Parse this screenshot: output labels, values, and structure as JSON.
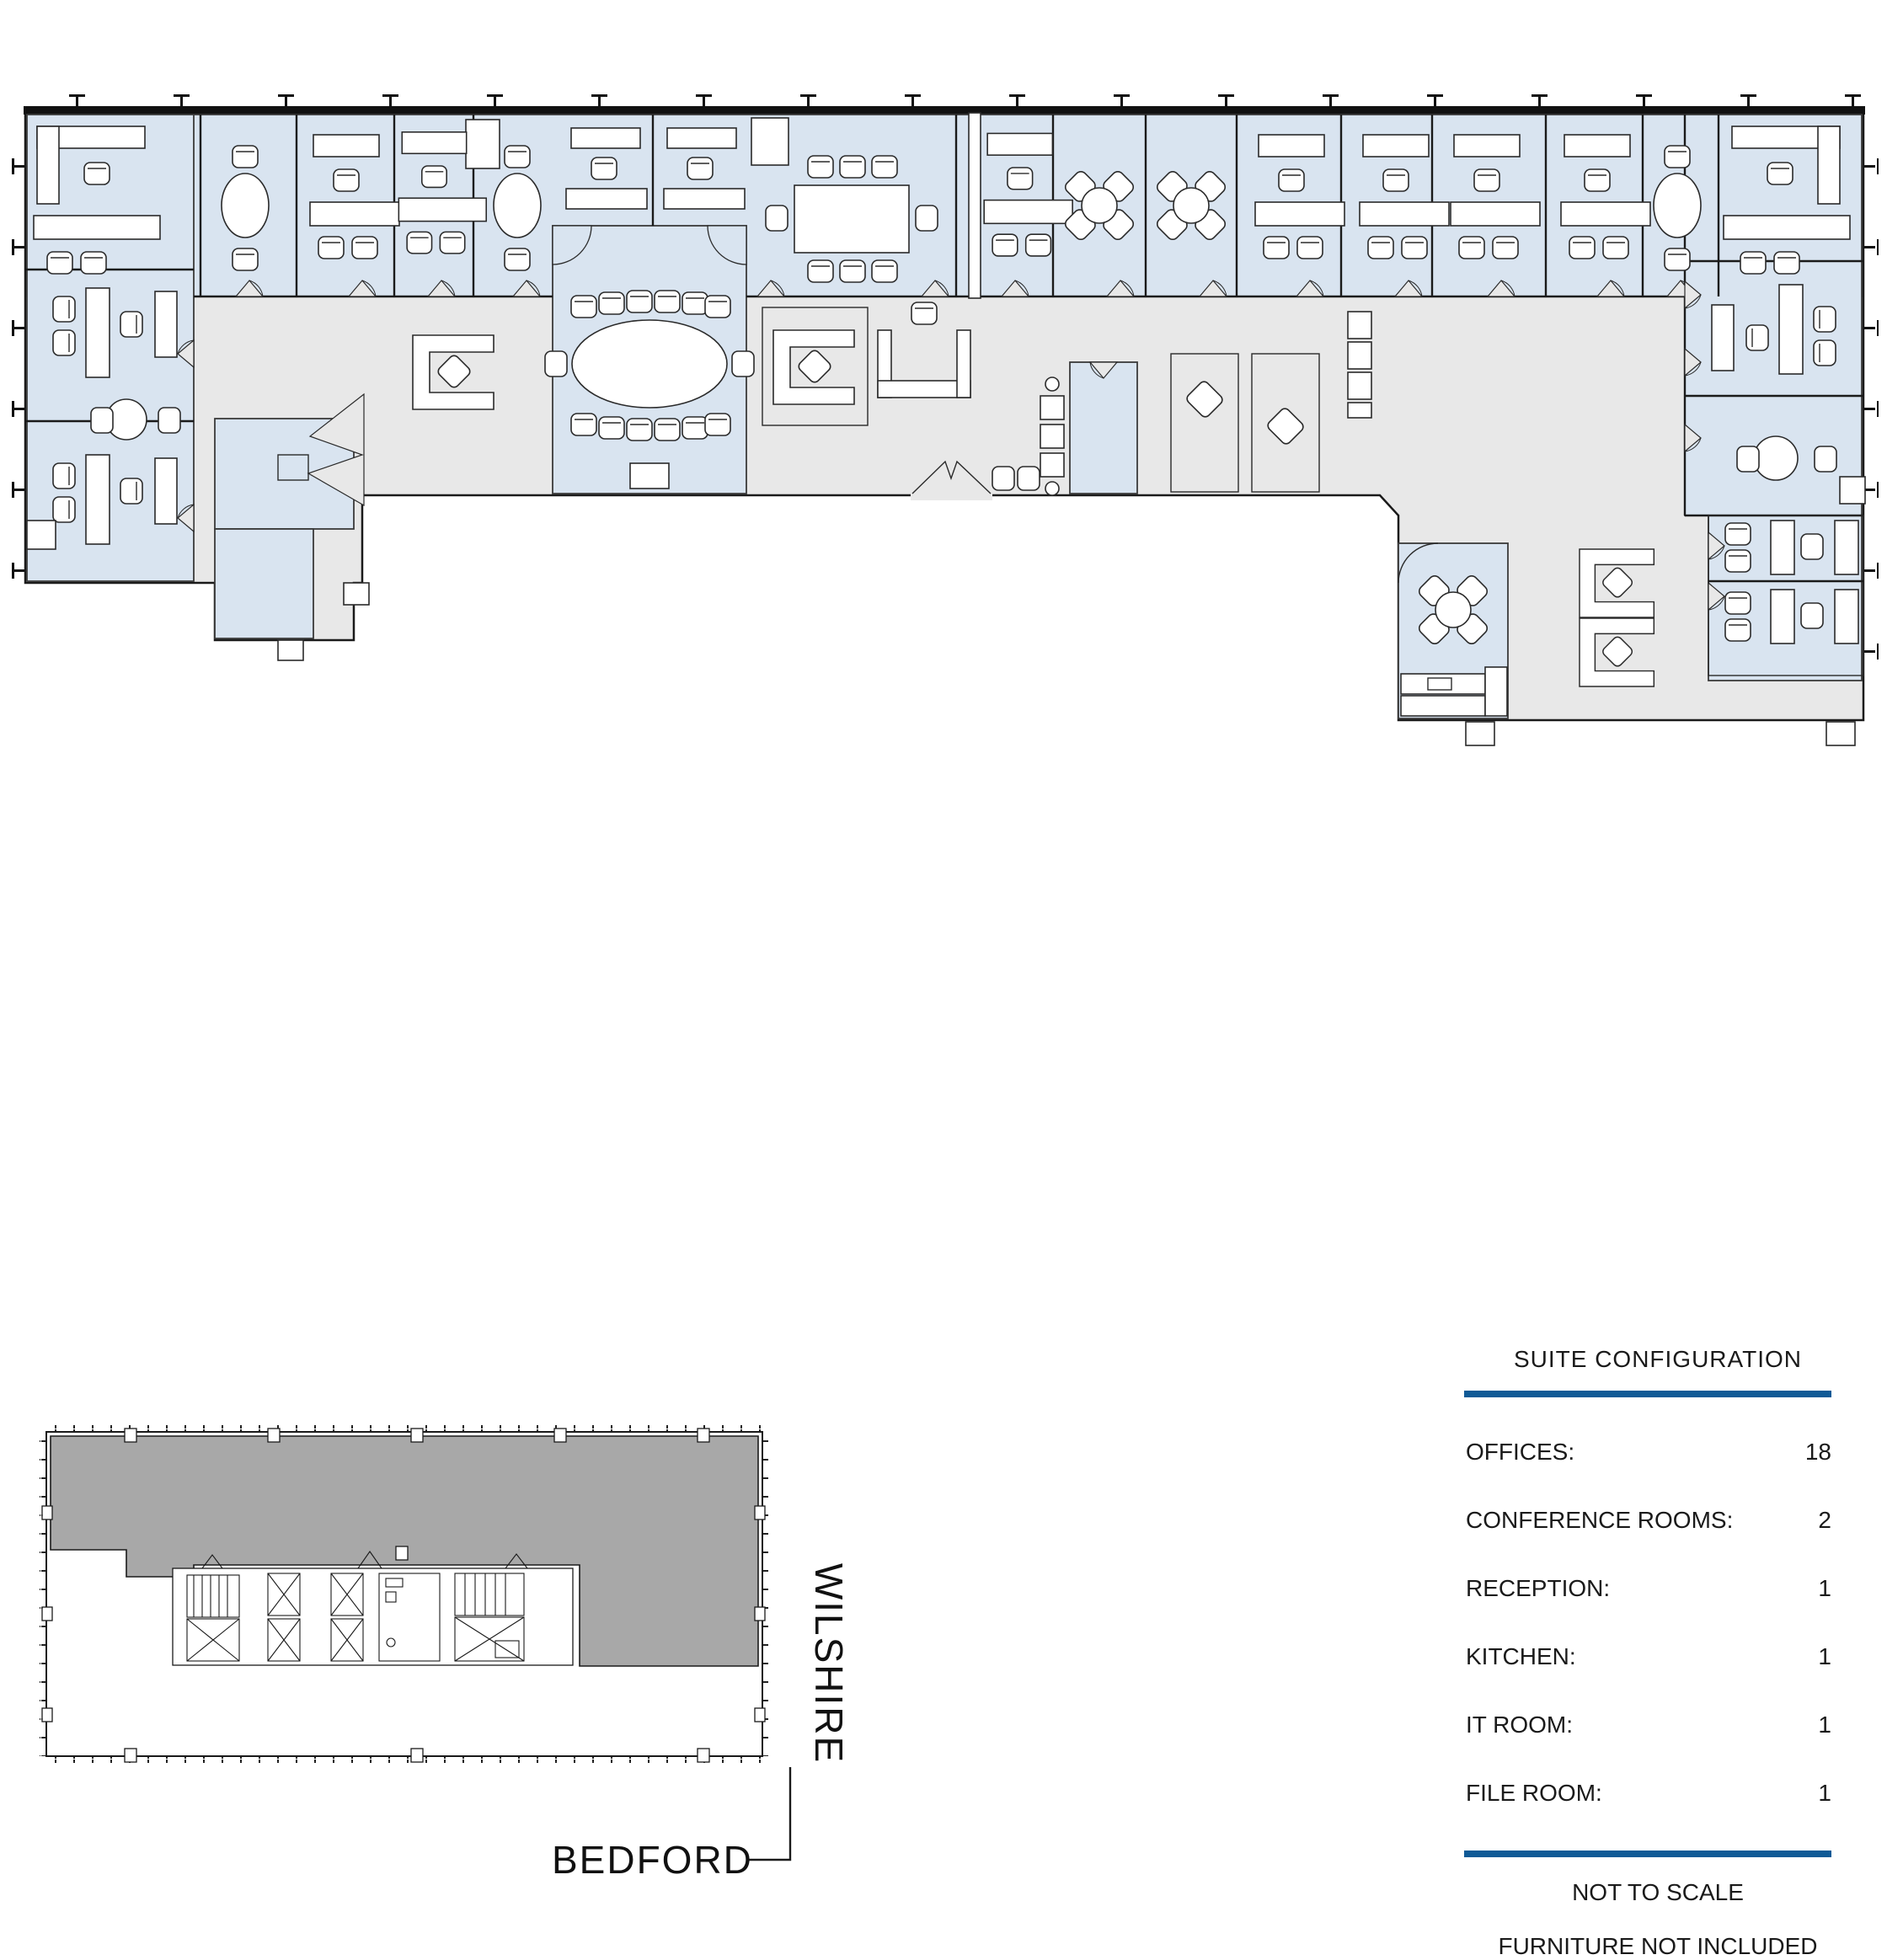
{
  "legend": {
    "title": "SUITE CONFIGURATION",
    "rows": [
      {
        "label": "OFFICES:",
        "value": "18"
      },
      {
        "label": "CONFERENCE ROOMS:",
        "value": "2"
      },
      {
        "label": "RECEPTION:",
        "value": "1"
      },
      {
        "label": "KITCHEN:",
        "value": "1"
      },
      {
        "label": "IT ROOM:",
        "value": "1"
      },
      {
        "label": "FILE ROOM:",
        "value": "1"
      }
    ],
    "notes": [
      "NOT TO SCALE",
      "FURNITURE NOT INCLUDED"
    ]
  },
  "key_plan": {
    "streets": {
      "right_vertical": "WILSHIRE",
      "bottom": "BEDFORD"
    }
  },
  "colors": {
    "office_fill": "#d9e4f0",
    "corridor_fill": "#e8e8e8",
    "keyplan_suite_fill": "#a8a8a8",
    "accent_rule": "#0f5a96",
    "wall": "#1a1a1a"
  }
}
